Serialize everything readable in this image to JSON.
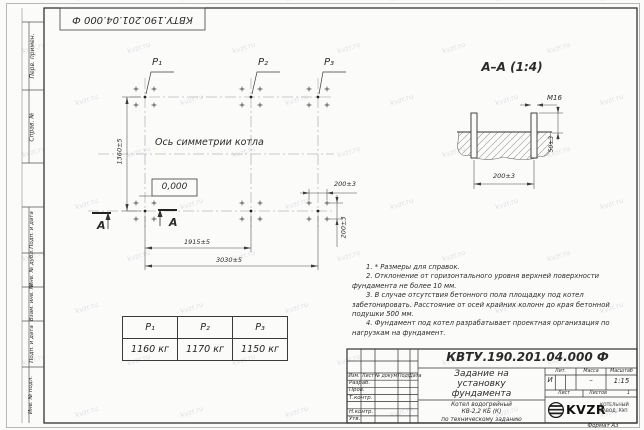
{
  "sheet": {
    "format_label": "Формат А3",
    "watermark_text": "kvzr.ru"
  },
  "top_stamp": {
    "doc_number": "КВТУ.190.201.04.000  Ф"
  },
  "margin": {
    "top_labels": [
      "Перв. примен.",
      "Справ. №"
    ],
    "bottom_labels": [
      "Подп. и дата",
      "Инв. № дубл.",
      "Взам. инв. №",
      "Подп. и дата",
      "Инв. № подл."
    ]
  },
  "plan": {
    "point_labels": [
      "P₁",
      "P₂",
      "P₃"
    ],
    "axis_caption": "Ось симметрии котла",
    "elevation_label": "0,000",
    "dim_height": "1360±5",
    "dim_span_mid": "1915±5",
    "dim_span_full": "3030±5",
    "dim_offset_x": "200±3",
    "dim_offset_y": "200±3",
    "section_mark": "А"
  },
  "section": {
    "title": "А–А (1:4)",
    "thread_label": "М16",
    "dim_protrusion": "50±3",
    "dim_bolt_spacing": "200±3"
  },
  "notes": [
    "1. * Размеры для справок.",
    "2. Отклонение от горизонтального уровня верхней поверхности фундамента не более 10 мм.",
    "3. В случае отсутствия бетонного пола площадку под котел забетонировать. Расстояние от осей крайних колонн до края бетонной подушки 500 мм.",
    "4. Фундамент под котел разрабатывает проектная организация по нагрузкам на фундамент."
  ],
  "load_table": {
    "headers": [
      "P₁",
      "P₂",
      "P₃"
    ],
    "values": [
      "1160 кг",
      "1170 кг",
      "1150 кг"
    ]
  },
  "title_block": {
    "doc_number": "КВТУ.190.201.04.000  Ф",
    "title_lines": [
      "Задание на",
      "установку",
      "фундамента"
    ],
    "subtitle_lines": [
      "Котел водогрейный",
      "КВ-2,2 КБ (К)",
      "по техническому заданию"
    ],
    "columns": [
      "Изм.",
      "Лист",
      "№ докум.",
      "Подп.",
      "Дата"
    ],
    "roles": [
      "Разраб.",
      "Пров.",
      "Т.контр.",
      "Н.контр.",
      "Утв."
    ],
    "lit_label": "Лит.",
    "lit_value": "И",
    "mass_label": "Масса",
    "mass_value": "–",
    "scale_label": "Масштаб",
    "scale_value": "1:15",
    "sheet_label": "Лист",
    "sheets_label": "Листов",
    "sheets_value": "1",
    "logo_text": "KVZR",
    "company_lines": [
      "КОТЕЛЬНЫЙ",
      "ЗАВОД, РЭП"
    ]
  }
}
